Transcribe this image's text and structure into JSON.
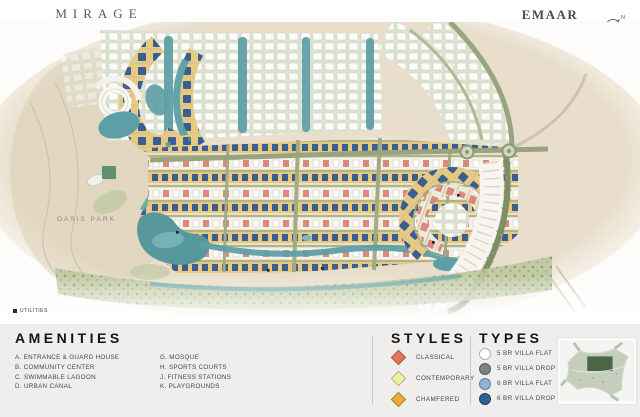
{
  "header": {
    "brand": "MIRAGE",
    "brand_tagline": "THE OASIS",
    "developer": "EMAAR",
    "compass_label": "N"
  },
  "map": {
    "park_label": "OASIS PARK"
  },
  "utilities_label": "UTILITIES",
  "legend": {
    "amenities": {
      "title": "AMENITIES",
      "col1": [
        "A. ENTRANCE & GUARD HOUSE",
        "B. COMMUNITY CENTER",
        "C. SWIMMABLE LAGOON",
        "D. URBAN CANAL"
      ],
      "col2": [
        "G. MOSQUE",
        "H. SPORTS COURTS",
        "J. FITNESS STATIONS",
        "K. PLAYGROUNDS"
      ]
    },
    "styles": {
      "title": "STYLES",
      "items": [
        {
          "label": "CLASSICAL",
          "color": "#e0745c"
        },
        {
          "label": "CONTEMPORARY",
          "color": "#eef0a3"
        },
        {
          "label": "CHAMFERED",
          "color": "#e9ad36"
        }
      ]
    },
    "types": {
      "title": "TYPES",
      "items": [
        {
          "label": "5 BR VILLA FLAT",
          "color": "#ffffff"
        },
        {
          "label": "5 BR VILLA DROP",
          "color": "#7d8285"
        },
        {
          "label": "6 BR VILLA FLAT",
          "color": "#8fb4d4"
        },
        {
          "label": "6 BR VILLA DROP",
          "color": "#2f6192"
        }
      ]
    }
  }
}
